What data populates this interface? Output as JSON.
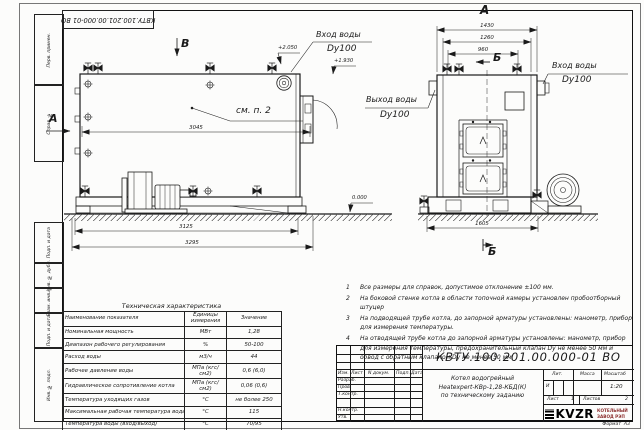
{
  "stamp_top": {
    "doc_number": "КВТУ.100.201.00.000-01 ВО"
  },
  "margin_labels": {
    "col1": "Перв. примен.",
    "col2": "Справ. №",
    "col3": "Подп. и дата",
    "col4": "Инв. № дубл.",
    "col5": "Взам. инв. №",
    "col6": "Подп. и дата",
    "col7": "Инв. № подл."
  },
  "side_view": {
    "marker_b": "В",
    "marker_a": "А",
    "see_note": "см. п. 2",
    "inlet_line1": "Вход воды",
    "inlet_line2": "Dy100",
    "elev_inlet": "+2.050",
    "elev_nozzle": "+1.930",
    "elev_zero": "0.000",
    "dim_body": "3045",
    "dim_frame": "3125",
    "dim_total": "3295"
  },
  "front_view": {
    "view_label": "А",
    "section_top": "Б",
    "section_bottom": "Б",
    "dim_width_total": "1430",
    "dim_width_mid": "1260",
    "dim_width_inner": "960",
    "dim_base": "1605",
    "outlet_line1": "Выход воды",
    "outlet_line2": "Dy100",
    "inlet_line1": "Вход воды",
    "inlet_line2": "Dy100"
  },
  "notes": {
    "items": [
      {
        "num": "1",
        "text": "Все размеры для справок, допустимое отклонение ±100 мм."
      },
      {
        "num": "2",
        "text": "На боковой стенке котла в области топочной камеры установлен пробоотборный штуцер"
      },
      {
        "num": "3",
        "text": "На подводящей трубе котла, до запорной арматуры установлены: манометр, прибор для измерения температуры."
      },
      {
        "num": "4",
        "text": "На отводящей трубе котла до запорной арматуры установлены: манометр, прибор для измерения температуры, предохранительный клапан Dу не менее 50 мм и обвод с обратным клапаном Dу не менее 50 мм."
      }
    ]
  },
  "tech_table": {
    "title": "Техническая характеристика",
    "headers": [
      "Наименование показателя",
      "Единицы измерения",
      "Значение"
    ],
    "rows": [
      [
        "Номинальная мощность",
        "МВт",
        "1,28"
      ],
      [
        "Диапазон рабочего регулирования",
        "%",
        "50-100"
      ],
      [
        "Расход воды",
        "м3/ч",
        "44"
      ],
      [
        "Рабочее давление воды",
        "МПа (кгс/см2)",
        "0,6 (6,0)"
      ],
      [
        "Гидравлическое сопротивление котла",
        "МПа (кгс/см2)",
        "0,06 (0,6)"
      ],
      [
        "Температура уходящих газов",
        "°С",
        "не более 250"
      ],
      [
        "Максимальная рабочая температура воды",
        "°С",
        "115"
      ],
      [
        "Температура воды (вход/выход)",
        "°С",
        "70/95"
      ],
      [
        "Габариты котла (длинна х ширина х высота)",
        "мм",
        "3295х1605х2050"
      ]
    ]
  },
  "title_block": {
    "doc_number": "КВТУ.100.201.00.000-01 ВО",
    "rev_headers": [
      "Изм.",
      "Лист",
      "N докум.",
      "Подп.",
      "Дата"
    ],
    "roles": [
      "Разраб.",
      "Пров.",
      "Т.контр.",
      "Н.контр.",
      "Утв."
    ],
    "description_line1": "Котел водогрейный",
    "description_line2": "Heatexpert-КВр-1,28-КБД(К)",
    "description_line3": "по техническому заданию",
    "lit_label": "Лит.",
    "lit_value": "И",
    "mass_label": "Масса",
    "scale_label": "Масштаб",
    "scale_value": "1:20",
    "sheet_label": "Лист",
    "sheet_value": "1",
    "sheets_label": "Листов",
    "sheets_value": "2",
    "company_logo": "KVZR",
    "company_line1": "КОТЕЛЬНЫЙ",
    "company_line2": "ЗАВОД РЭП",
    "format_label": "Формат",
    "format_value": "А3"
  }
}
